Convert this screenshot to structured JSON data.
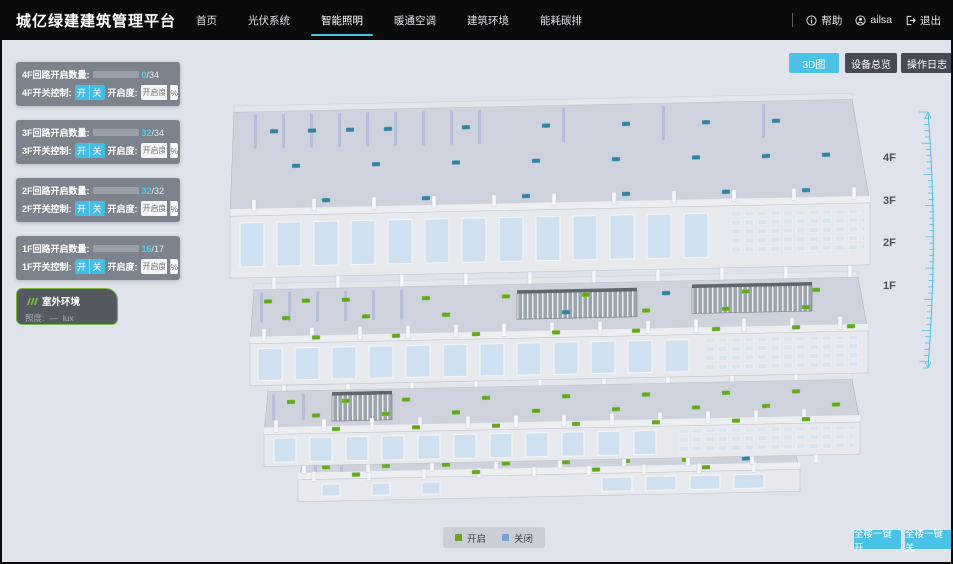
{
  "header": {
    "title": "城亿绿建建筑管理平台",
    "nav": [
      {
        "label": "首页",
        "active": false
      },
      {
        "label": "光伏系统",
        "active": false
      },
      {
        "label": "智能照明",
        "active": true
      },
      {
        "label": "暖通空调",
        "active": false
      },
      {
        "label": "建筑环境",
        "active": false
      },
      {
        "label": "能耗碳排",
        "active": false
      }
    ],
    "help": "帮助",
    "user": "ailsa",
    "logout": "退出"
  },
  "toolbar": {
    "view_3d": "3D图",
    "device_overview": "设备总览",
    "operation_log": "操作日志"
  },
  "floor_panels": [
    {
      "floor": "4F",
      "count_label": "4F回路开启数量:",
      "count_current": "0",
      "count_total": "/34",
      "progress_pct": 0,
      "switch_label": "4F开关控制:",
      "btn_on": "开",
      "btn_off": "关",
      "dim_label": "开启度:",
      "dim_placeholder": "开启度",
      "dim_unit": "%"
    },
    {
      "floor": "3F",
      "count_label": "3F回路开启数量:",
      "count_current": "32",
      "count_total": "/34",
      "progress_pct": 94,
      "switch_label": "3F开关控制:",
      "btn_on": "开",
      "btn_off": "关",
      "dim_label": "开启度:",
      "dim_placeholder": "开启度",
      "dim_unit": "%"
    },
    {
      "floor": "2F",
      "count_label": "2F回路开启数量:",
      "count_current": "32",
      "count_total": "/32",
      "progress_pct": 100,
      "switch_label": "2F开关控制:",
      "btn_on": "开",
      "btn_off": "关",
      "dim_label": "开启度:",
      "dim_placeholder": "开启度",
      "dim_unit": "%"
    },
    {
      "floor": "1F",
      "count_label": "1F回路开启数量:",
      "count_current": "16",
      "count_total": "/17",
      "progress_pct": 94,
      "switch_label": "1F开关控制:",
      "btn_on": "开",
      "btn_off": "关",
      "dim_label": "开启度:",
      "dim_placeholder": "开启度",
      "dim_unit": "%"
    }
  ],
  "outdoor": {
    "title": "室外环境",
    "metric_label": "照度:",
    "metric_value": "—",
    "metric_unit": "lux"
  },
  "floor_labels": [
    "4F",
    "3F",
    "2F",
    "1F"
  ],
  "legend": {
    "on": "开启",
    "off": "关闭"
  },
  "bulk": {
    "all_on": "全楼一键开",
    "all_off": "全楼一键关"
  },
  "colors": {
    "accent": "#4ac2e6",
    "header_bg": "#0a0b0d",
    "light_on": "#61a51d",
    "light_off": "#2f7e9d",
    "legend_off": "#7d9fd3",
    "outdoor_border": "#7ab742",
    "background": "#dfe4ec"
  }
}
